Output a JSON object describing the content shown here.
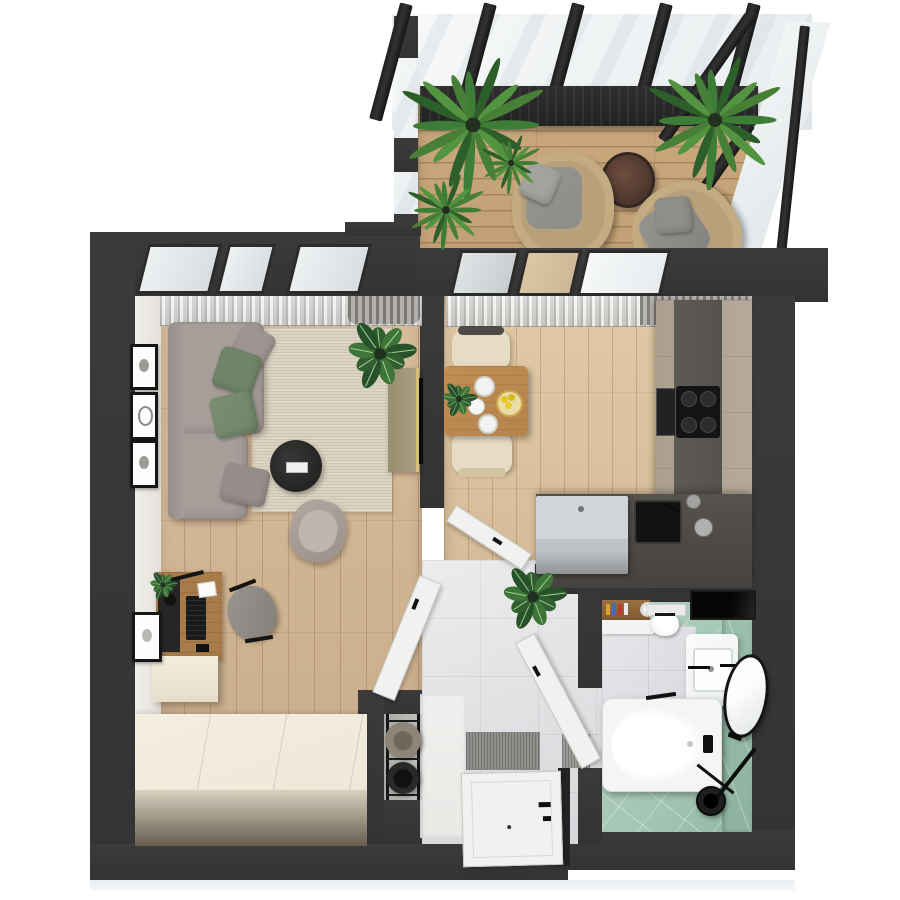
{
  "scene": {
    "type": "3d-floor-plan-top-down-render",
    "description": "Dollhouse top view of a one-bedroom apartment with glazed balcony terrace",
    "background": "#ffffff"
  },
  "colors": {
    "wall": "#3b3b3b",
    "wallDeep": "#333333",
    "wood": "#d8bd9b",
    "woodKitchen": "#e2c9a6",
    "deck": "#cba97d",
    "rug": "#dcd4c2",
    "hallTile": "#e0e0e3",
    "bathTileGreen": "#a4c6b5",
    "greenWallTile": "#9cc0ae",
    "marble": "#d9dadd",
    "sofa": "#a79e9a",
    "pillowGreen": "#6f8468",
    "pillowGray": "#9d9391",
    "counterDark": "#55514d",
    "cabinetBeige": "#b5a997",
    "steel": "#c0c3c5",
    "tableWood": "#b5854e",
    "chairCream": "#e6dcc4",
    "wardrobeTop": "#efe8d9",
    "wardrobeFront": "#675d4f",
    "curtain": "#cfcfcc",
    "glass": "#e9edef",
    "doorWhite": "#f1f1ef",
    "ink": "#161616",
    "consoleTan": "#a79c80",
    "gold": "#d6c078",
    "tub": "#f4f6f6",
    "deskWood": "#a87c4a",
    "rattan": "#c4ab82",
    "cushionGray": "#8d8c88",
    "walnut": "#5d4037",
    "matGray": "#8e8e8a",
    "benchLight": "#e9e9e6",
    "artGray": "#9a9a97"
  },
  "plant_palettes": {
    "palm": [
      "#3e7d38",
      "#2d5f2a",
      "#539440",
      "#477f37"
    ],
    "leafy": [
      "#2f5f31",
      "#3d7437",
      "#26512a"
    ],
    "midrib": "#a8d193"
  },
  "rooms": [
    {
      "name": "balcony-terrace",
      "features": [
        "glass-pergola-roof",
        "five-pergola-beams",
        "folded-canopy",
        "wood-deck",
        "two-rattan-armchairs-with-gray-cushions",
        "round-walnut-side-table",
        "three-palm-plants",
        "potted-palm",
        "glass-railing"
      ]
    },
    {
      "name": "living-room",
      "features": [
        "corner-sofa-taupe",
        "two-green-pillows",
        "two-gray-pillows",
        "beige-area-rug",
        "round-black-coffee-table-with-remote",
        "tv-console-with-tv",
        "large-houseplant",
        "wood-desk-with-keyboard-lamp",
        "office-chair",
        "lounge-armchair",
        "four-wall-art-frames",
        "floating-cabinet",
        "wardrobe",
        "sheer-curtains",
        "windows"
      ]
    },
    {
      "name": "kitchen-dining",
      "features": [
        "wood-dining-table",
        "two-cream-chairs",
        "plates",
        "teapot",
        "bowl-of-lemons",
        "herb-sprigs",
        "beige-cabinet-run",
        "dark-counter",
        "gas-cooktop",
        "built-in-oven",
        "black-sink",
        "steel-appliance",
        "jars",
        "curtains",
        "windows",
        "white-interior-door"
      ]
    },
    {
      "name": "hallway",
      "features": [
        "marble-tile-floor",
        "entrance-door",
        "striped-doormat",
        "small-mat",
        "coat-niche-with-two-hats",
        "bench-cabinet",
        "houseplant",
        "living-room-door",
        "bathroom-door"
      ]
    },
    {
      "name": "bathroom",
      "features": [
        "white-bathtub",
        "vanity-with-basin",
        "black-faucet",
        "round-leaning-mirror",
        "toilet",
        "black-wall-niche",
        "wood-shelf-with-bottles",
        "towel-rolls",
        "black-shower-set",
        "green-diagonal-tile-floor",
        "marble-tile-area",
        "green-tile-wall"
      ]
    }
  ]
}
